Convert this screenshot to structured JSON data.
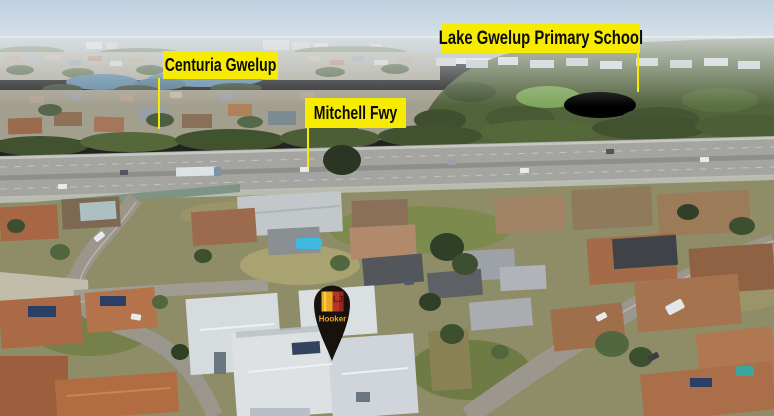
{
  "annotations": {
    "labels": [
      {
        "id": "school",
        "text": "Lake Gwelup Primary School"
      },
      {
        "id": "centuria",
        "text": "Centuria Gwelup"
      },
      {
        "id": "freeway",
        "text": "Mitchell Fwy"
      }
    ],
    "marker": {
      "brand_initials": "LJ",
      "brand_name": "Hooker"
    }
  },
  "colors": {
    "label-bg": "#f7ec00",
    "label-text": "#0b0b0b",
    "leader-line": "#f7ec00",
    "pin-black": "#17120d",
    "logo-gold": "#f3b629",
    "logo-gold-dark": "#e39b16",
    "logo-red": "#b5352a",
    "logo-red-dark": "#7e1d15",
    "logo-initials": "#5f1410",
    "logo-name": "#f2a51f",
    "sky-top": "#bdd0e0",
    "sky-bottom": "#e7ebee",
    "water": "#5d86a4",
    "freeway-asphalt": "#a4a5a0",
    "roof-terracotta": "#a96a46",
    "roof-white": "#d9dee1",
    "tree-dark": "#41522f"
  }
}
